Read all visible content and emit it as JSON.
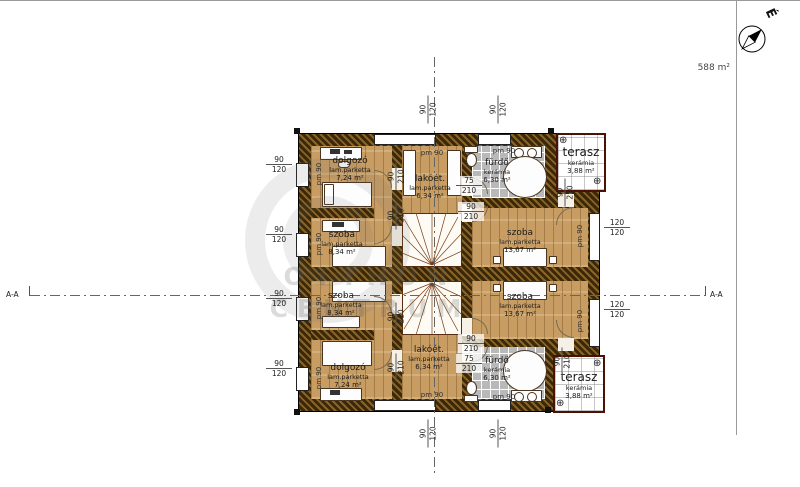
{
  "site": {
    "area_label": "588 m²",
    "north_label": "É",
    "section_left": "A-A",
    "section_right": "A-A"
  },
  "watermark": {
    "line1": "OTTHON",
    "line2": "CENTRUM"
  },
  "icons": {
    "drain": "⊕"
  },
  "rooms": {
    "upper": {
      "dolgozo": {
        "name": "dolgozó",
        "floor": "lam.parketta",
        "area": "7,24 m²"
      },
      "szoba_small": {
        "name": "szoba",
        "floor": "lam.parketta",
        "area": "8,34 m²"
      },
      "lakoet": {
        "name": "lakóét.",
        "floor": "lam.parketta",
        "area": "6,34 m²"
      },
      "furdo": {
        "name": "fürdő",
        "floor": "kerámia",
        "area": "6,30 m²"
      },
      "szoba_large": {
        "name": "szoba",
        "floor": "lam.parketta",
        "area": "13,67 m²"
      },
      "terasz": {
        "name": "terasz",
        "floor": "kerámia",
        "area": "3,88 m²"
      }
    },
    "lower": {
      "dolgozo": {
        "name": "dolgozó",
        "floor": "lam.parketta",
        "area": "7,24 m²"
      },
      "szoba_small": {
        "name": "szoba",
        "floor": "lam.parketta",
        "area": "8,34 m²"
      },
      "lakoet": {
        "name": "lakóét.",
        "floor": "lam.parketta",
        "area": "6,34 m²"
      },
      "furdo": {
        "name": "fürdő",
        "floor": "kerámia",
        "area": "6,30 m²"
      },
      "szoba_large": {
        "name": "szoba",
        "floor": "lam.parketta",
        "area": "13,67 m²"
      },
      "terasz": {
        "name": "terasz",
        "floor": "kerámia",
        "area": "3,88 m²"
      }
    }
  },
  "dims": {
    "n75": "75",
    "n90": "90",
    "n120": "120",
    "n210": "210",
    "pm90": "pm 90"
  }
}
